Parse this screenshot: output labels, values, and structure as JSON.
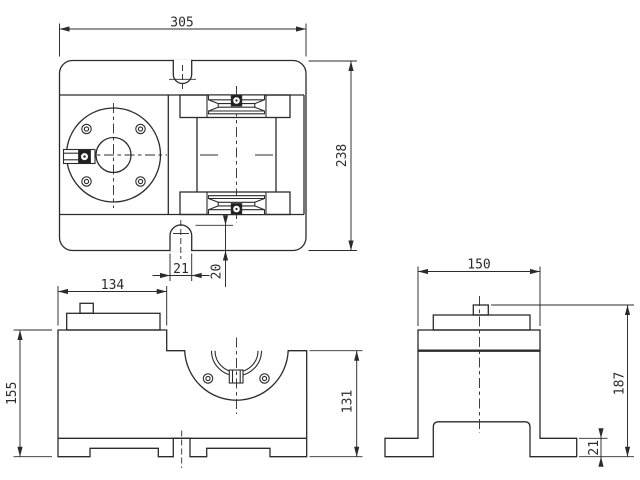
{
  "colors": {
    "line": "#2b2b2b",
    "background": "#ffffff"
  },
  "dims": {
    "top": {
      "width": "305",
      "height": "238",
      "slot_width": "21",
      "slot_depth": "20"
    },
    "front": {
      "width": "134",
      "height": "155",
      "right_height": "131"
    },
    "side": {
      "width": "150",
      "height": "187",
      "foot_height": "21"
    }
  }
}
